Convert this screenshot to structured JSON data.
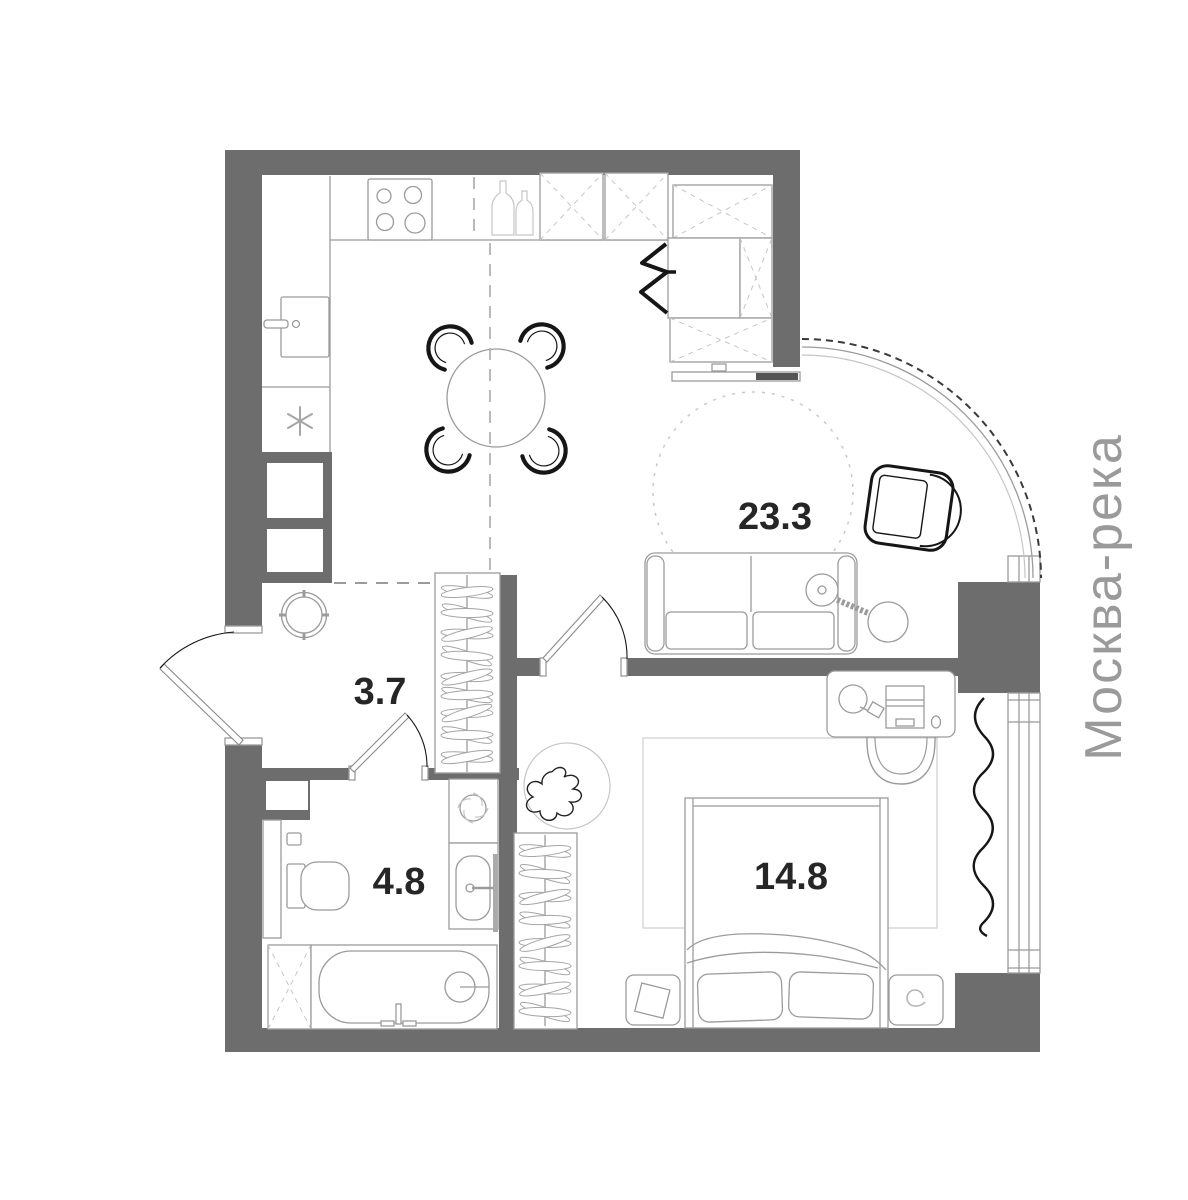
{
  "plan": {
    "watermark": "Москва-река",
    "rooms": [
      {
        "id": "living-kitchen",
        "area": "23.3"
      },
      {
        "id": "hallway",
        "area": "3.7"
      },
      {
        "id": "bathroom",
        "area": "4.8"
      },
      {
        "id": "bedroom",
        "area": "14.8"
      }
    ]
  },
  "colors": {
    "background": "#ffffff",
    "wall": "#6d6d6d",
    "outline": "#9b9b9b",
    "light_outline": "#c6c6c6",
    "dark_line": "#161616",
    "label_text": "#262626",
    "watermark_text": "#9a9a9a"
  },
  "icons": [
    "stove-icon",
    "kitchen-sink-icon",
    "fridge-snowflake-icon",
    "wine-bottles-icon",
    "dining-table-icon",
    "dining-chair-icon",
    "cabinet-x-icon",
    "closet-rail-zigzag-icon",
    "tv-icon",
    "sofa-icon",
    "round-rug-icon",
    "floor-lamp-icon",
    "armchair-icon",
    "balcony-glazing-arc",
    "pouf-icon",
    "hanger-wardrobe-icon",
    "entry-door",
    "interior-door",
    "toilet-icon",
    "washing-machine-icon",
    "bathroom-sink-icon",
    "towel-rail-icon",
    "bathtub-icon",
    "bed-icon",
    "pillow-icon",
    "nightstand-icon",
    "desk-icon",
    "desk-chair-icon",
    "desk-lamp-icon",
    "laptop-icon",
    "mouse-icon",
    "plant-icon",
    "curtain-icon",
    "window",
    "rug-icon"
  ]
}
